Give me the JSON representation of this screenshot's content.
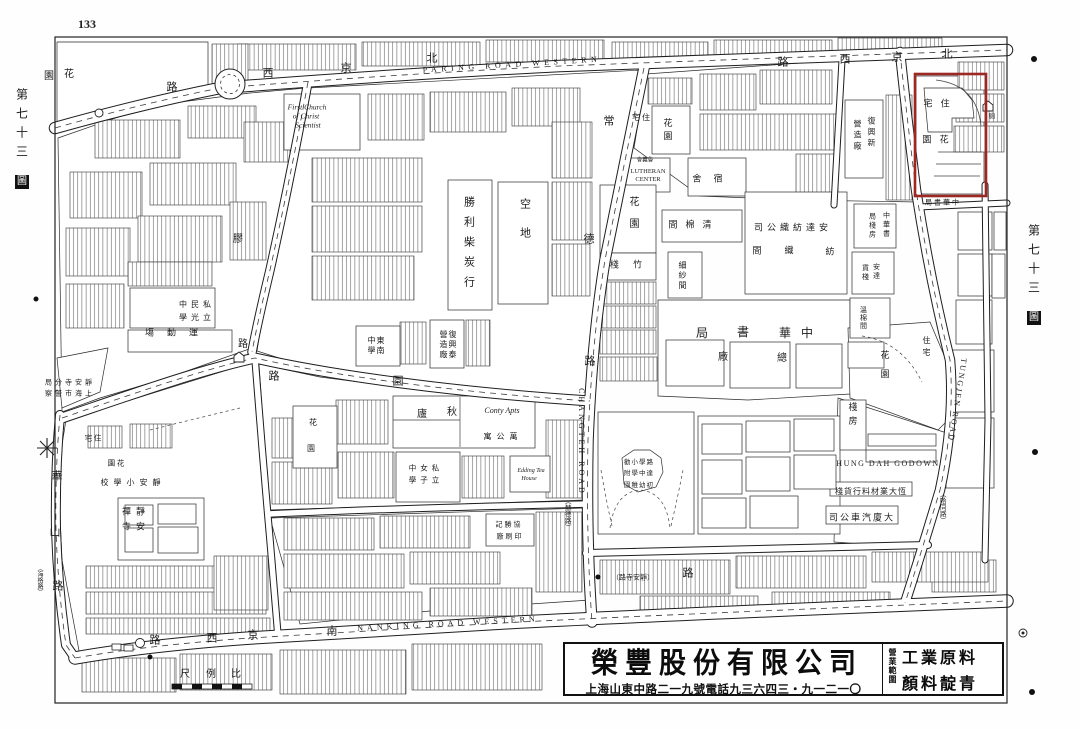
{
  "page": {
    "folio": "133",
    "plate_prefix": "第七十三",
    "plate_boxed": "圖"
  },
  "ad": {
    "company": "榮豐股份有限公司",
    "contact": "上海山東中路二一九號電話九三六四三・九一二一〇",
    "scope_label": "營業範圍",
    "scope_line1": "工業原料",
    "scope_line2": "顏料靛青"
  },
  "map": {
    "highlight_color": "#9c2723",
    "labels": [
      {
        "n": "road-label-paring-road-western-en",
        "t": "PARING ROAD WESTERN",
        "x": 512,
        "y": 65,
        "s": 8,
        "ls": 4.5,
        "r": -3.5
      },
      {
        "n": "road-label-nanking-road-western-en",
        "t": "NANKING ROAD WESTERN",
        "x": 448,
        "y": 624,
        "s": 8,
        "ls": 4,
        "r": -3
      },
      {
        "n": "road-label-changteh-road-en",
        "t": "CHANGTEH ROAD",
        "x": 581,
        "y": 442,
        "s": 8,
        "ls": 3,
        "r": 90
      },
      {
        "n": "road-label-tungjen-road-en",
        "t": "TUNGJEN ROAD",
        "x": 957,
        "y": 400,
        "s": 8,
        "ls": 2,
        "r": 99
      },
      {
        "n": "label-hung-dah-godown",
        "t": "HUNG DAH GODOWN",
        "x": 888,
        "y": 464,
        "s": 8,
        "ls": 1.5
      },
      {
        "n": "label-first-church-1",
        "t": "First Church",
        "x": 307,
        "y": 107,
        "s": 7.5,
        "i": 1
      },
      {
        "n": "label-first-church-2",
        "t": "of Christ",
        "x": 306,
        "y": 116,
        "s": 7.5,
        "i": 1
      },
      {
        "n": "label-first-church-3",
        "t": "Scientist",
        "x": 308,
        "y": 125,
        "s": 7.5,
        "i": 1
      },
      {
        "n": "label-lutheran-center-1",
        "t": "LUTHERAN",
        "x": 648,
        "y": 172,
        "s": 6.5
      },
      {
        "n": "label-lutheran-center-2",
        "t": "CENTER",
        "x": 648,
        "y": 180,
        "s": 6.5
      },
      {
        "n": "label-lutheran-chinese",
        "t": "會義魯",
        "x": 645,
        "y": 161,
        "s": 5.5
      },
      {
        "n": "label-conty-apts",
        "t": "Conty Apts",
        "x": 502,
        "y": 411,
        "s": 8,
        "i": 1
      },
      {
        "n": "label-edding-tea-house-1",
        "t": "Edding Tea",
        "x": 531,
        "y": 471,
        "s": 6,
        "i": 1
      },
      {
        "n": "label-edding-tea-house-2",
        "t": "House",
        "x": 529,
        "y": 479,
        "s": 6,
        "i": 1
      },
      {
        "n": "road-char-peking-w",
        "t": "路",
        "x": 172,
        "y": 88,
        "s": 11
      },
      {
        "t": "西",
        "x": 268,
        "y": 74,
        "s": 11
      },
      {
        "t": "京",
        "x": 346,
        "y": 69,
        "s": 11
      },
      {
        "t": "北",
        "x": 432,
        "y": 59,
        "s": 11
      },
      {
        "t": "路",
        "x": 783,
        "y": 63,
        "s": 11
      },
      {
        "t": "西",
        "x": 845,
        "y": 60,
        "s": 11
      },
      {
        "t": "京",
        "x": 897,
        "y": 58,
        "s": 11
      },
      {
        "t": "北",
        "x": 947,
        "y": 55,
        "s": 11
      },
      {
        "n": "road-char-nanking",
        "t": "路",
        "x": 155,
        "y": 641,
        "s": 11
      },
      {
        "t": "西",
        "x": 212,
        "y": 639,
        "s": 11
      },
      {
        "t": "京",
        "x": 253,
        "y": 636,
        "s": 11
      },
      {
        "t": "南",
        "x": 332,
        "y": 632,
        "s": 11
      },
      {
        "n": "road-label-jingansi-paren",
        "t": "（路寺安靜）",
        "x": 633,
        "y": 578,
        "s": 7
      },
      {
        "t": "路",
        "x": 688,
        "y": 574,
        "s": 11
      },
      {
        "n": "road-char-changteh",
        "t": "常",
        "x": 609,
        "y": 122,
        "s": 11
      },
      {
        "t": "德",
        "x": 589,
        "y": 240,
        "s": 11
      },
      {
        "t": "路",
        "x": 590,
        "y": 362,
        "s": 11
      },
      {
        "n": "road-label-hart-paren",
        "t": "（赫德路）",
        "x": 566,
        "y": 514,
        "v": 1,
        "s": 6.5
      },
      {
        "n": "road-char-yuyuan",
        "t": "園",
        "x": 398,
        "y": 382,
        "s": 11
      },
      {
        "t": "路",
        "x": 274,
        "y": 377,
        "s": 11
      },
      {
        "n": "road-char-jiaozhou",
        "t": "膠",
        "x": 238,
        "y": 240,
        "s": 10
      },
      {
        "t": "路",
        "x": 243,
        "y": 345,
        "s": 10
      },
      {
        "n": "road-char-huashan",
        "t": "華",
        "x": 57,
        "y": 477,
        "s": 11
      },
      {
        "t": "山",
        "x": 55,
        "y": 533,
        "s": 11
      },
      {
        "t": "路",
        "x": 58,
        "y": 587,
        "s": 11
      },
      {
        "n": "road-label-haig-paren",
        "t": "（海格路）",
        "x": 39,
        "y": 580,
        "v": 1,
        "s": 6
      },
      {
        "n": "road-label-hardoon-paren",
        "t": "（哈同路）",
        "x": 941,
        "y": 507,
        "v": 1,
        "s": 6.5
      },
      {
        "n": "label-garden-nw-1",
        "t": "園",
        "x": 49,
        "y": 77,
        "s": 10
      },
      {
        "n": "label-garden-nw-2",
        "t": "花",
        "x": 69,
        "y": 75,
        "s": 10
      },
      {
        "n": "label-police-station-1",
        "t": "局分寺安靜",
        "x": 70,
        "y": 383,
        "s": 7,
        "ls": 3
      },
      {
        "n": "label-police-station-2",
        "t": "察警市海上",
        "x": 70,
        "y": 394,
        "s": 7,
        "ls": 3
      },
      {
        "n": "label-residence-w",
        "t": "宅 住",
        "x": 93,
        "y": 438,
        "s": 7.5
      },
      {
        "n": "label-garden-w",
        "t": "園 花",
        "x": 116,
        "y": 463,
        "s": 7.5
      },
      {
        "n": "label-jingan-primary-school",
        "t": "校學小安靜",
        "x": 133,
        "y": 483,
        "s": 8,
        "ls": 5
      },
      {
        "n": "label-jingan-temple-1",
        "t": "禪靜",
        "x": 136,
        "y": 512,
        "s": 9,
        "ls": 5
      },
      {
        "n": "label-jingan-temple-2",
        "t": "寺安",
        "x": 136,
        "y": 527,
        "s": 9,
        "ls": 5
      },
      {
        "n": "label-minkwang-school-1",
        "t": "中民私",
        "x": 197,
        "y": 305,
        "s": 8,
        "ls": 4
      },
      {
        "n": "label-minkwang-school-2",
        "t": "學光立",
        "x": 197,
        "y": 318,
        "s": 8,
        "ls": 4
      },
      {
        "n": "label-sports-ground",
        "t": "塲動運",
        "x": 178,
        "y": 333,
        "s": 9,
        "ls": 13
      },
      {
        "n": "label-shengli-coal-firm",
        "t": "勝利柴炭行",
        "x": 468,
        "y": 246,
        "v": 1,
        "s": 11,
        "ls": 9
      },
      {
        "n": "label-vacant-lot",
        "t": "空地",
        "x": 524,
        "y": 227,
        "v": 1,
        "s": 11,
        "ls": 18
      },
      {
        "n": "label-tungnan-school-1",
        "t": "東南",
        "x": 380,
        "y": 346,
        "v": 1,
        "s": 8,
        "ls": 2
      },
      {
        "n": "label-tungnan-school-2",
        "t": "中學",
        "x": 371,
        "y": 346,
        "v": 1,
        "s": 8,
        "ls": 2
      },
      {
        "n": "label-fuxingtai-1",
        "t": "復興泰",
        "x": 452,
        "y": 345,
        "v": 1,
        "s": 8,
        "ls": 2
      },
      {
        "n": "label-fuxingtai-2",
        "t": "營造廠",
        "x": 443,
        "y": 345,
        "v": 1,
        "s": 8,
        "ls": 2
      },
      {
        "n": "label-residence-n",
        "t": "宅 住",
        "x": 641,
        "y": 118,
        "s": 8
      },
      {
        "n": "label-garden-n",
        "t": "花園",
        "x": 667,
        "y": 131,
        "v": 1,
        "s": 9,
        "ls": 4
      },
      {
        "n": "label-dormitory",
        "t": "舍 宿",
        "x": 710,
        "y": 179,
        "s": 9,
        "ls": 5
      },
      {
        "n": "label-garden-e",
        "t": "花園",
        "x": 632,
        "y": 218,
        "v": 1,
        "s": 10,
        "ls": 12
      },
      {
        "n": "label-cotton-cleaning-room",
        "t": "間棉清",
        "x": 694,
        "y": 225,
        "s": 9,
        "ls": 8
      },
      {
        "n": "label-anda-cotton-mill",
        "t": "司公織紡達安",
        "x": 793,
        "y": 228,
        "s": 9,
        "ls": 4
      },
      {
        "n": "label-spinning-room-1",
        "t": "間",
        "x": 757,
        "y": 251,
        "s": 9
      },
      {
        "n": "label-spinning-room-2",
        "t": "織",
        "x": 789,
        "y": 251,
        "s": 9
      },
      {
        "n": "label-spinning-room-3",
        "t": "紡",
        "x": 830,
        "y": 252,
        "s": 9
      },
      {
        "n": "label-bamboo-godown",
        "t": "棧 竹",
        "x": 629,
        "y": 265,
        "s": 9,
        "ls": 6
      },
      {
        "n": "label-fine-yarn-room",
        "t": "細紗間",
        "x": 682,
        "y": 276,
        "v": 1,
        "s": 8,
        "ls": 2
      },
      {
        "n": "label-fuxingxin-1",
        "t": "復興新",
        "x": 871,
        "y": 133,
        "v": 1,
        "s": 8,
        "ls": 3
      },
      {
        "n": "label-fuxingxin-2",
        "t": "營造廠",
        "x": 857,
        "y": 136,
        "v": 1,
        "s": 8,
        "ls": 3
      },
      {
        "n": "label-chunghwa-book-1",
        "t": "局",
        "x": 702,
        "y": 333,
        "s": 12
      },
      {
        "n": "label-chunghwa-book-2",
        "t": "書",
        "x": 743,
        "y": 332,
        "s": 12
      },
      {
        "n": "label-chunghwa-book-3",
        "t": "華",
        "x": 785,
        "y": 333,
        "s": 12
      },
      {
        "n": "label-chunghwa-book-4",
        "t": "中",
        "x": 807,
        "y": 333,
        "s": 12
      },
      {
        "n": "label-main-works-1",
        "t": "廠",
        "x": 723,
        "y": 358,
        "s": 10
      },
      {
        "n": "label-main-works-2",
        "t": "總",
        "x": 782,
        "y": 359,
        "s": 10
      },
      {
        "n": "label-book-godown-1",
        "t": "中華書",
        "x": 886,
        "y": 225,
        "v": 1,
        "s": 7,
        "ls": 2
      },
      {
        "n": "label-book-godown-2",
        "t": "局棧房",
        "x": 872,
        "y": 226,
        "v": 1,
        "s": 7,
        "ls": 2
      },
      {
        "n": "label-anda-godown-1",
        "t": "安達",
        "x": 876,
        "y": 272,
        "v": 1,
        "s": 7,
        "ls": 2
      },
      {
        "n": "label-anda-godown-2",
        "t": "貨棧",
        "x": 865,
        "y": 273,
        "v": 1,
        "s": 7,
        "ls": 2
      },
      {
        "n": "label-cotton-room",
        "t": "溫棉間",
        "x": 863,
        "y": 318,
        "v": 1,
        "s": 7,
        "ls": 1
      },
      {
        "n": "label-residence-villa",
        "t": "住宅",
        "x": 926,
        "y": 348,
        "v": 1,
        "s": 8,
        "ls": 4
      },
      {
        "n": "label-garden-villa",
        "t": "花園",
        "x": 884,
        "y": 369,
        "v": 1,
        "s": 9,
        "ls": 10
      },
      {
        "n": "label-godown-rooms",
        "t": "棧房",
        "x": 852,
        "y": 416,
        "v": 1,
        "s": 9,
        "ls": 5
      },
      {
        "n": "label-hengda-materials",
        "t": "棧貨行料材業大恆",
        "x": 871,
        "y": 492,
        "s": 8,
        "ls": 1
      },
      {
        "n": "label-dasha-motor-co",
        "t": "司公車汽廈大",
        "x": 862,
        "y": 518,
        "s": 9,
        "ls": 2
      },
      {
        "n": "label-chunghwa-small",
        "t": "局書華中",
        "x": 943,
        "y": 203,
        "s": 7,
        "ls": 2
      },
      {
        "n": "label-residence-redbox",
        "t": "宅 住",
        "x": 938,
        "y": 104,
        "s": 9,
        "ls": 3
      },
      {
        "n": "label-garden-redbox",
        "t": "園 花",
        "x": 937,
        "y": 140,
        "s": 9,
        "ls": 3
      },
      {
        "n": "label-latrine",
        "t": "廁",
        "x": 992,
        "y": 117,
        "s": 6.5
      },
      {
        "n": "label-qiulu-1",
        "t": "廬",
        "x": 422,
        "y": 415,
        "s": 10
      },
      {
        "n": "label-qiulu-2",
        "t": "秋",
        "x": 452,
        "y": 413,
        "s": 10
      },
      {
        "n": "label-apartments",
        "t": "寓公萬",
        "x": 503,
        "y": 437,
        "s": 8,
        "ls": 5
      },
      {
        "n": "label-girls-school-1",
        "t": "中女私",
        "x": 426,
        "y": 468,
        "s": 7.5,
        "ls": 4
      },
      {
        "n": "label-girls-school-2",
        "t": "學子立",
        "x": 426,
        "y": 480,
        "s": 7.5,
        "ls": 4
      },
      {
        "n": "label-garden-c-1",
        "t": "花",
        "x": 313,
        "y": 423,
        "s": 8
      },
      {
        "n": "label-garden-c-2",
        "t": "園",
        "x": 311,
        "y": 449,
        "s": 8
      },
      {
        "n": "label-kindergarten-1",
        "t": "勸小學路",
        "x": 639,
        "y": 463,
        "s": 6.5,
        "ls": 1
      },
      {
        "n": "label-kindergarten-2",
        "t": "附學中達",
        "x": 639,
        "y": 474,
        "s": 6.5,
        "ls": 1
      },
      {
        "n": "label-kindergarten-3",
        "t": "園稚幼初",
        "x": 639,
        "y": 486,
        "s": 6.5,
        "ls": 1
      },
      {
        "n": "label-printing-works-1",
        "t": "記勝協",
        "x": 509,
        "y": 525,
        "s": 7,
        "ls": 2
      },
      {
        "n": "label-printing-works-2",
        "t": "廠刷印",
        "x": 510,
        "y": 537,
        "s": 7,
        "ls": 2
      },
      {
        "n": "label-scale-1",
        "t": "尺",
        "x": 185,
        "y": 675,
        "s": 10
      },
      {
        "n": "label-scale-2",
        "t": "例",
        "x": 211,
        "y": 675,
        "s": 10
      },
      {
        "n": "label-scale-3",
        "t": "比",
        "x": 236,
        "y": 675,
        "s": 10
      }
    ]
  }
}
